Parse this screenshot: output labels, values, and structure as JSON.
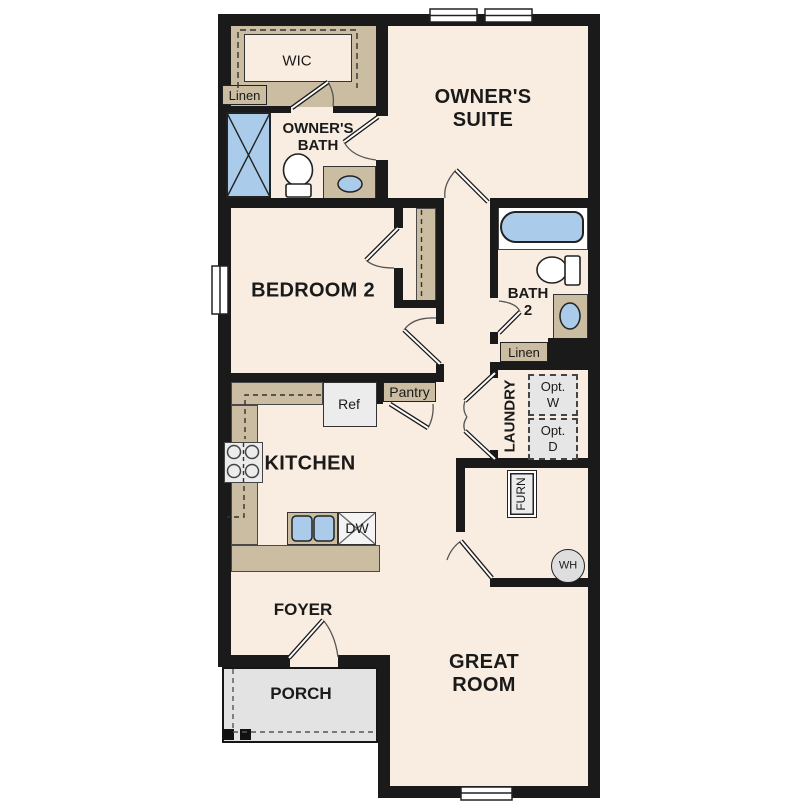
{
  "floorplan": {
    "labels": {
      "wic": "WIC",
      "linen_owner": "Linen",
      "owners_bath": [
        "OWNER'S",
        "BATH"
      ],
      "owners_suite": [
        "OWNER'S",
        "SUITE"
      ],
      "bedroom2": "BEDROOM 2",
      "bath2": [
        "BATH",
        "2"
      ],
      "linen_bath2": "Linen",
      "pantry": "Pantry",
      "laundry": "LAUNDRY",
      "opt_w": [
        "Opt.",
        "W"
      ],
      "opt_d": [
        "Opt.",
        "D"
      ],
      "ref": "Ref",
      "kitchen": "KITCHEN",
      "dw": "DW",
      "furn": "FURN",
      "wh": "WH",
      "foyer": "FOYER",
      "porch": "PORCH",
      "great_room": [
        "GREAT",
        "ROOM"
      ]
    },
    "colors": {
      "floor": "#f8ede0",
      "wall": "#1a1a1a",
      "casework": "#cbbda1",
      "porch": "#e3e3e3",
      "blue": "#aacbea",
      "appliance": "#ececec"
    }
  }
}
